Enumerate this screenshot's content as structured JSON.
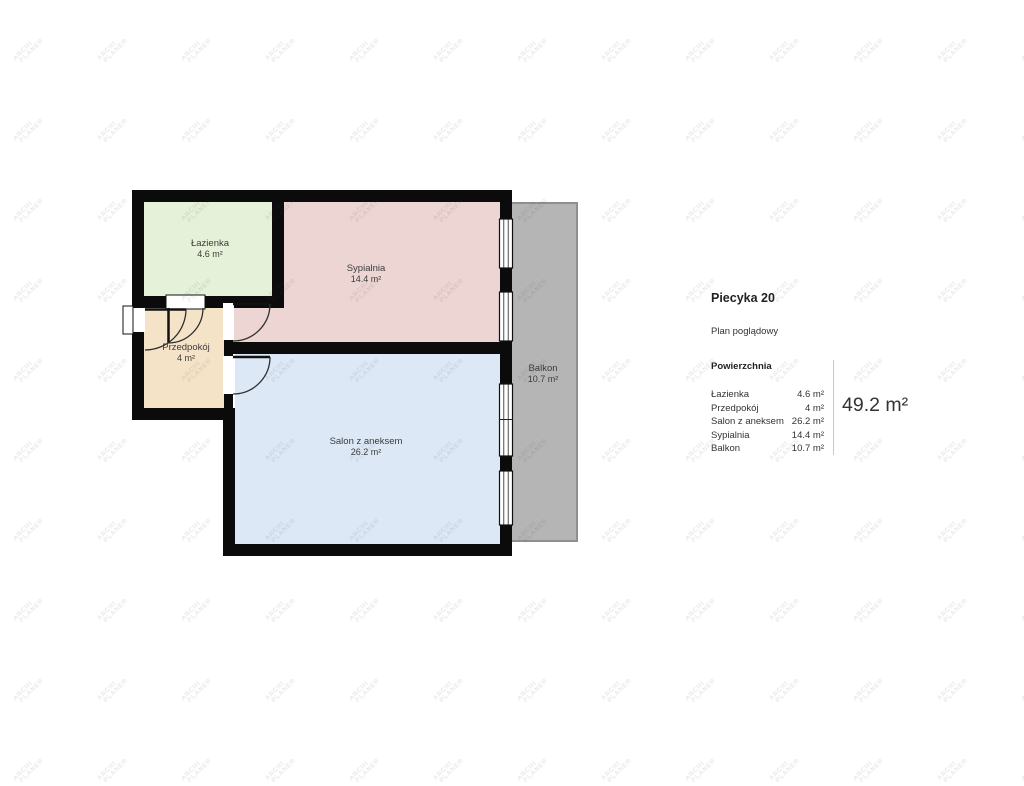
{
  "watermark": {
    "line1": "ARCHI",
    "line2": "PLANER"
  },
  "plan": {
    "wall_color": "#0b0b0b",
    "rooms": [
      {
        "name": "Łazienka",
        "area": "4.6 m²",
        "color": "#e5f1d8"
      },
      {
        "name": "Sypialnia",
        "area": "14.4 m²",
        "color": "#ecd5d3"
      },
      {
        "name": "Przedpokój",
        "area": "4 m²",
        "color": "#f5e3c7"
      },
      {
        "name": "Salon z aneksem",
        "area": "26.2 m²",
        "color": "#dde8f7"
      },
      {
        "name": "Balkon",
        "area": "10.7 m²",
        "color": "#b5b5b5"
      }
    ]
  },
  "panel": {
    "title": "Piecyka 20",
    "subtitle": "Plan poglądowy",
    "section_heading": "Powierzchnia",
    "rows": [
      {
        "label": "Łazienka",
        "value": "4.6 m²"
      },
      {
        "label": "Przedpokój",
        "value": "4 m²"
      },
      {
        "label": "Salon z aneksem",
        "value": "26.2 m²"
      },
      {
        "label": "Sypialnia",
        "value": "14.4 m²"
      },
      {
        "label": "Balkon",
        "value": "10.7 m²"
      }
    ],
    "total": "49.2 m²"
  }
}
